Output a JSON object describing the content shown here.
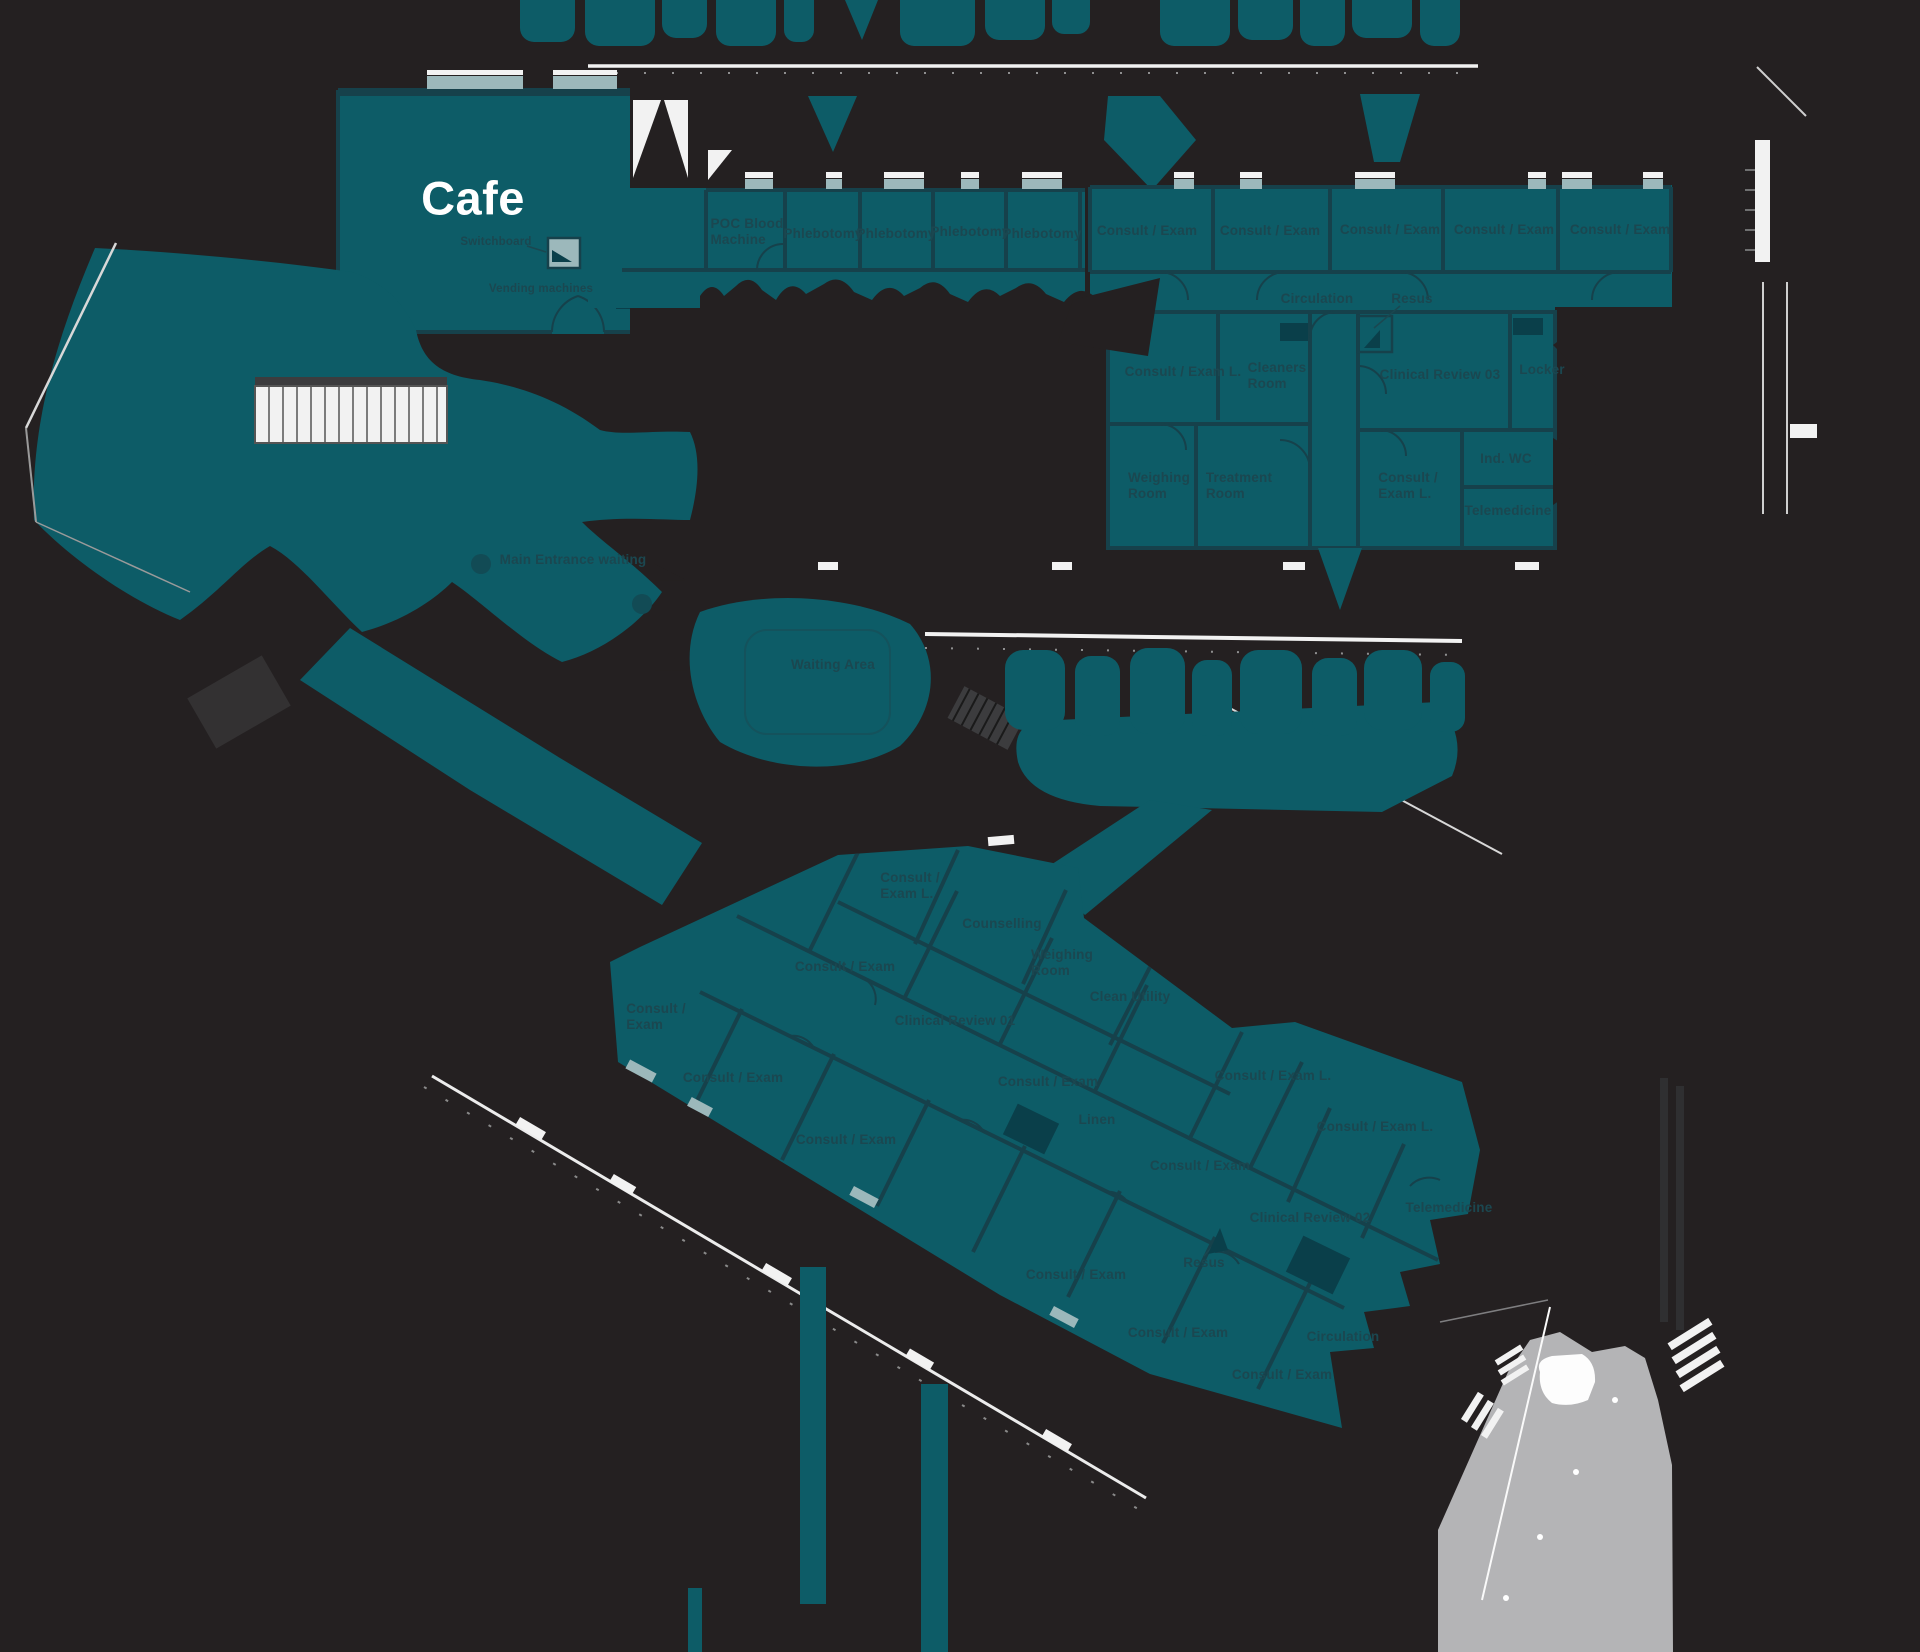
{
  "palette": {
    "background": "#242021",
    "room_fill": "#0d5c67",
    "wall_line": "#16414b",
    "label_text": "#1b4750",
    "window_light": "#9cb8bb",
    "exterior_line": "#f2f2f2",
    "hardscape_gray": "#b4b4b6",
    "cafe_text": "#ffffff"
  },
  "areas": {
    "cafe": {
      "name": "Cafe",
      "annotations": [
        "Switchboard",
        "Vending machines"
      ]
    },
    "blood_suite_rooms": [
      "POC Blood Machine",
      "Phlebotomy",
      "Phlebotomy",
      "Phlebotomy",
      "Phlebotomy"
    ],
    "north_consult_suite": {
      "corridor_labels": [
        "Circulation",
        "Resus"
      ],
      "rooms": [
        "Consult / Exam",
        "Consult / Exam",
        "Consult / Exam",
        "Consult / Exam",
        "Consult / Exam",
        "Consult / Exam L.",
        "Cleaners Room",
        "Clinical Review 03",
        "Locker",
        "Weighing Room",
        "Treatment Room",
        "Consult / Exam L.",
        "Ind. WC",
        "Telemedicine"
      ]
    },
    "entrance_labels": [
      "Main Entrance waiting",
      "Waiting Area"
    ],
    "south_wing": {
      "corridor_labels": [
        "Circulation",
        "Resus"
      ],
      "rooms": [
        "Consult / Exam L.",
        "Counselling",
        "Weighing Room",
        "Consult / Exam",
        "Clean Utility",
        "Consult / Exam",
        "Clinical Review 01",
        "Consult / Exam",
        "Consult / Exam",
        "Consult / Exam L.",
        "Linen",
        "Consult / Exam L.",
        "Consult / Exam",
        "Consult / Exam",
        "Clinical Review 02",
        "Telemedicine",
        "Consult / Exam",
        "Consult / Exam",
        "Consult / Exam"
      ]
    }
  },
  "labels": [
    {
      "n": "room-label-cafe",
      "t": "Cafe",
      "x": 473,
      "y": 198,
      "cls": "cafe"
    },
    {
      "n": "annotation-switchboard",
      "t": "Switchboard",
      "x": 496,
      "y": 243,
      "cls": "ann"
    },
    {
      "n": "annotation-vending-machines",
      "t": "Vending machines",
      "x": 541,
      "y": 290,
      "cls": "ann"
    },
    {
      "n": "room-label-poc-blood-machine",
      "t": "POC Blood\nMachine",
      "x": 747,
      "y": 232,
      "a": "l"
    },
    {
      "n": "room-label-phlebotomy-1",
      "t": "Phlebotomy",
      "x": 823,
      "y": 234
    },
    {
      "n": "room-label-phlebotomy-2",
      "t": "Phlebotomy",
      "x": 896,
      "y": 234
    },
    {
      "n": "room-label-phlebotomy-3",
      "t": "Phlebotomy",
      "x": 970,
      "y": 232
    },
    {
      "n": "room-label-phlebotomy-4",
      "t": "Phlebotomy",
      "x": 1042,
      "y": 234
    },
    {
      "n": "room-label-consult-exam-n1",
      "t": "Consult / Exam",
      "x": 1147,
      "y": 231
    },
    {
      "n": "room-label-consult-exam-n2",
      "t": "Consult / Exam",
      "x": 1270,
      "y": 231
    },
    {
      "n": "room-label-consult-exam-n3",
      "t": "Consult / Exam",
      "x": 1390,
      "y": 230
    },
    {
      "n": "room-label-consult-exam-n4",
      "t": "Consult / Exam",
      "x": 1504,
      "y": 230
    },
    {
      "n": "room-label-consult-exam-n5",
      "t": "Consult / Exam",
      "x": 1620,
      "y": 230
    },
    {
      "n": "corridor-label-circulation-north",
      "t": "Circulation",
      "x": 1317,
      "y": 299
    },
    {
      "n": "room-label-resus-north",
      "t": "Resus",
      "x": 1412,
      "y": 299
    },
    {
      "n": "room-label-consult-exam-l-north",
      "t": "Consult / Exam L.",
      "x": 1183,
      "y": 372
    },
    {
      "n": "room-label-cleaners-room",
      "t": "Cleaners\nRoom",
      "x": 1277,
      "y": 376,
      "a": "l"
    },
    {
      "n": "room-label-clinical-review-03",
      "t": "Clinical Review 03",
      "x": 1440,
      "y": 375
    },
    {
      "n": "room-label-locker",
      "t": "Locker",
      "x": 1542,
      "y": 370
    },
    {
      "n": "room-label-weighing-room-north",
      "t": "Weighing\nRoom",
      "x": 1159,
      "y": 486,
      "a": "l"
    },
    {
      "n": "room-label-treatment-room",
      "t": "Treatment\nRoom",
      "x": 1239,
      "y": 486,
      "a": "l"
    },
    {
      "n": "room-label-consult-exam-l-north2",
      "t": "Consult /\nExam L.",
      "x": 1408,
      "y": 486,
      "a": "l"
    },
    {
      "n": "room-label-ind-wc",
      "t": "Ind. WC",
      "x": 1506,
      "y": 459
    },
    {
      "n": "room-label-telemedicine-north",
      "t": "Telemedicine",
      "x": 1508,
      "y": 511
    },
    {
      "n": "area-label-main-entrance-waiting",
      "t": "Main Entrance waiting",
      "x": 573,
      "y": 560
    },
    {
      "n": "area-label-waiting-area",
      "t": "Waiting Area",
      "x": 833,
      "y": 665
    },
    {
      "n": "room-label-consult-exam-l-w1",
      "t": "Consult /\nExam L.",
      "x": 910,
      "y": 886,
      "a": "l"
    },
    {
      "n": "room-label-counselling",
      "t": "Counselling",
      "x": 1002,
      "y": 924
    },
    {
      "n": "room-label-weighing-room-wing",
      "t": "Weighing\nRoom",
      "x": 1062,
      "y": 963,
      "a": "l"
    },
    {
      "n": "room-label-consult-exam-w1",
      "t": "Consult / Exam",
      "x": 845,
      "y": 967
    },
    {
      "n": "room-label-clean-utility",
      "t": "Clean Utility",
      "x": 1130,
      "y": 997
    },
    {
      "n": "room-label-consult-exam-w2",
      "t": "Consult /\nExam",
      "x": 656,
      "y": 1017,
      "a": "l"
    },
    {
      "n": "room-label-clinical-review-01",
      "t": "Clinical Review 01",
      "x": 955,
      "y": 1021
    },
    {
      "n": "room-label-consult-exam-w3",
      "t": "Consult / Exam",
      "x": 733,
      "y": 1078
    },
    {
      "n": "room-label-consult-exam-w4",
      "t": "Consult / Exam",
      "x": 1048,
      "y": 1082
    },
    {
      "n": "room-label-consult-exam-l-w2",
      "t": "Consult / Exam L.",
      "x": 1273,
      "y": 1076
    },
    {
      "n": "room-label-linen",
      "t": "Linen",
      "x": 1097,
      "y": 1120
    },
    {
      "n": "room-label-consult-exam-l-w3",
      "t": "Consult / Exam L.",
      "x": 1375,
      "y": 1127
    },
    {
      "n": "room-label-consult-exam-w5",
      "t": "Consult / Exam",
      "x": 846,
      "y": 1140
    },
    {
      "n": "room-label-consult-exam-w6",
      "t": "Consult / Exam",
      "x": 1200,
      "y": 1166
    },
    {
      "n": "room-label-clinical-review-02",
      "t": "Clinical Review 02",
      "x": 1310,
      "y": 1218
    },
    {
      "n": "room-label-telemedicine-wing",
      "t": "Telemedicine",
      "x": 1449,
      "y": 1208
    },
    {
      "n": "room-label-resus-wing",
      "t": "Resus",
      "x": 1204,
      "y": 1263
    },
    {
      "n": "room-label-consult-exam-w7",
      "t": "Consult / Exam",
      "x": 1076,
      "y": 1275
    },
    {
      "n": "room-label-consult-exam-w8",
      "t": "Consult / Exam",
      "x": 1178,
      "y": 1333
    },
    {
      "n": "corridor-label-circulation-wing",
      "t": "Circulation",
      "x": 1343,
      "y": 1337
    },
    {
      "n": "room-label-consult-exam-w9",
      "t": "Consult / Exam",
      "x": 1282,
      "y": 1375
    }
  ]
}
